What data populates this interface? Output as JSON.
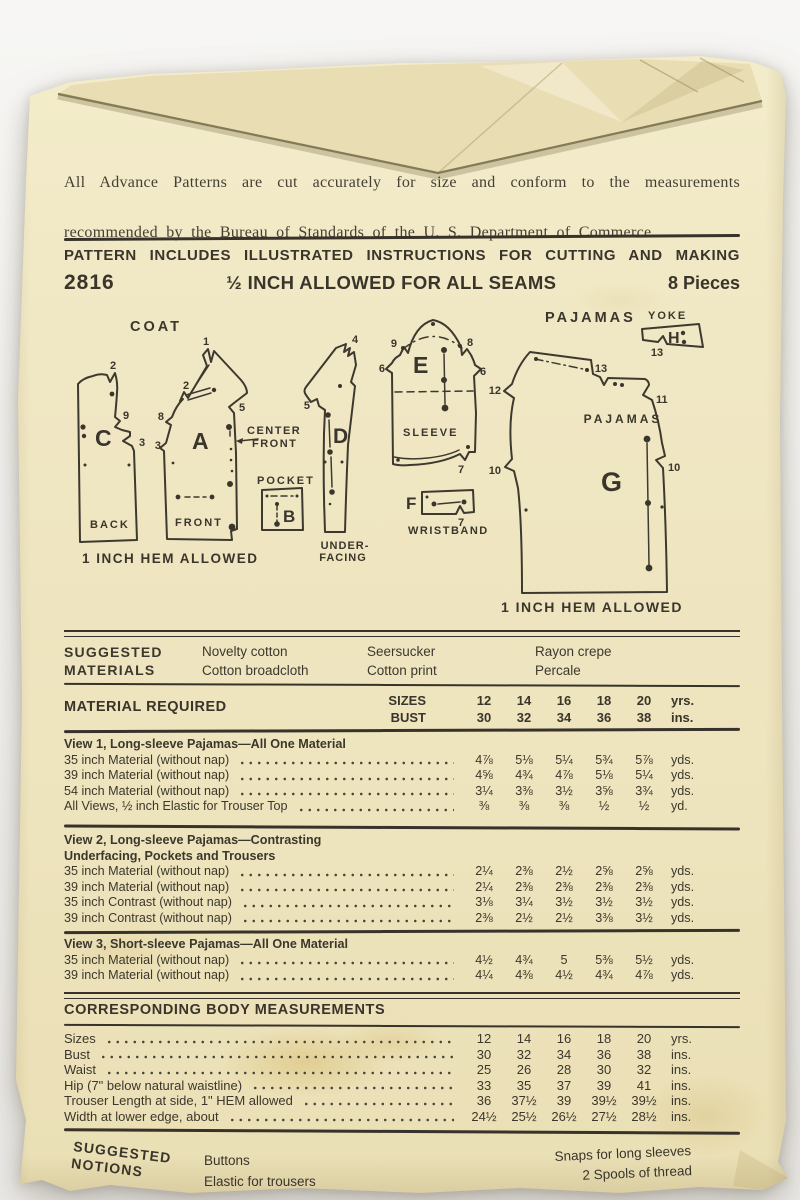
{
  "intro": {
    "line1": "All Advance Patterns are cut accurately for size and conform to the measurements",
    "line2": "recommended by the Bureau of Standards of the U. S. Department of Commerce."
  },
  "header": {
    "includes_line": "PATTERN INCLUDES ILLUSTRATED INSTRUCTIONS FOR CUTTING AND MAKING",
    "pattern_number": "2816",
    "seam_allowance": "½ INCH ALLOWED FOR ALL SEAMS",
    "piece_count": "8 Pieces"
  },
  "diagram": {
    "coat_label": "COAT",
    "pajamas_label": "PAJAMAS",
    "yoke_label": "YOKE",
    "coat_hem_note": "1 INCH HEM ALLOWED",
    "pajamas_hem_note": "1 INCH HEM ALLOWED",
    "pieces": {
      "back": {
        "letter": "C",
        "name": "BACK",
        "notches": [
          "2",
          "9",
          "3"
        ]
      },
      "front": {
        "letter": "A",
        "name": "FRONT",
        "notches": [
          "1",
          "2",
          "8",
          "3",
          "5"
        ],
        "center_front_line1": "CENTER",
        "center_front_line2": "FRONT"
      },
      "pocket": {
        "letter": "B",
        "name": "POCKET"
      },
      "underfacing": {
        "letter": "D",
        "name_line1": "UNDER-",
        "name_line2": "FACING",
        "notches": [
          "4",
          "5"
        ]
      },
      "sleeve": {
        "letter": "E",
        "name": "SLEEVE",
        "notches": [
          "9",
          "8",
          "6",
          "6",
          "7"
        ]
      },
      "wristband": {
        "letter": "F",
        "name": "WRISTBAND",
        "notches": [
          "7"
        ]
      },
      "pajama_pant": {
        "letter": "G",
        "name": "PAJAMAS",
        "notches": [
          "12",
          "13",
          "11",
          "10",
          "10"
        ]
      },
      "yoke": {
        "letter": "H",
        "notches": [
          "13"
        ]
      }
    }
  },
  "materials": {
    "label_line1": "SUGGESTED",
    "label_line2": "MATERIALS",
    "columns": [
      {
        "line1": "Novelty cotton",
        "line2": "Cotton broadcloth"
      },
      {
        "line1": "Seersucker",
        "line2": "Cotton print"
      },
      {
        "line1": "Rayon crepe",
        "line2": "Percale"
      }
    ]
  },
  "material_required": {
    "title": "MATERIAL REQUIRED",
    "sizes_label": "SIZES",
    "bust_label": "BUST",
    "sizes": [
      "12",
      "14",
      "16",
      "18",
      "20"
    ],
    "sizes_unit": "yrs.",
    "bust": [
      "30",
      "32",
      "34",
      "36",
      "38"
    ],
    "bust_unit": "ins."
  },
  "views": [
    {
      "title_line1": "View 1, Long-sleeve Pajamas—All One Material",
      "rows": [
        {
          "label": "35 inch Material (without nap)",
          "values": [
            "4⅞",
            "5⅛",
            "5¼",
            "5¾",
            "5⅞"
          ],
          "unit": "yds."
        },
        {
          "label": "39 inch Material (without nap)",
          "values": [
            "4⅝",
            "4¾",
            "4⅞",
            "5⅛",
            "5¼"
          ],
          "unit": "yds."
        },
        {
          "label": "54 inch Material (without nap)",
          "values": [
            "3¼",
            "3⅜",
            "3½",
            "3⅝",
            "3¾"
          ],
          "unit": "yds."
        },
        {
          "label": "All Views, ½ inch Elastic for Trouser Top",
          "values": [
            "⅜",
            "⅜",
            "⅜",
            "½",
            "½"
          ],
          "unit": "yd."
        }
      ]
    },
    {
      "title_line1": "View 2, Long-sleeve Pajamas—Contrasting",
      "title_line2": "Underfacing, Pockets and Trousers",
      "rows": [
        {
          "label": "35 inch Material (without nap)",
          "values": [
            "2¼",
            "2⅜",
            "2½",
            "2⅝",
            "2⅝"
          ],
          "unit": "yds."
        },
        {
          "label": "39 inch Material (without nap)",
          "values": [
            "2¼",
            "2⅜",
            "2⅜",
            "2⅜",
            "2⅜"
          ],
          "unit": "yds."
        },
        {
          "label": "35 inch Contrast (without nap)",
          "values": [
            "3⅛",
            "3¼",
            "3½",
            "3½",
            "3½"
          ],
          "unit": "yds."
        },
        {
          "label": "39 inch Contrast (without nap)",
          "values": [
            "2⅜",
            "2½",
            "2½",
            "3⅜",
            "3½"
          ],
          "unit": "yds."
        }
      ]
    },
    {
      "title_line1": "View 3, Short-sleeve Pajamas—All One Material",
      "rows": [
        {
          "label": "35 inch Material (without nap)",
          "values": [
            "4½",
            "4¾",
            "5",
            "5⅜",
            "5½"
          ],
          "unit": "yds."
        },
        {
          "label": "39 inch Material (without nap)",
          "values": [
            "4¼",
            "4⅜",
            "4½",
            "4¾",
            "4⅞"
          ],
          "unit": "yds."
        }
      ]
    }
  ],
  "body_measurements": {
    "title": "CORRESPONDING BODY MEASUREMENTS",
    "rows": [
      {
        "label": "Sizes",
        "values": [
          "12",
          "14",
          "16",
          "18",
          "20"
        ],
        "unit": "yrs."
      },
      {
        "label": "Bust",
        "values": [
          "30",
          "32",
          "34",
          "36",
          "38"
        ],
        "unit": "ins."
      },
      {
        "label": "Waist",
        "values": [
          "25",
          "26",
          "28",
          "30",
          "32"
        ],
        "unit": "ins."
      },
      {
        "label": "Hip (7\" below natural waistline)",
        "values": [
          "33",
          "35",
          "37",
          "39",
          "41"
        ],
        "unit": "ins."
      },
      {
        "label": "Trouser Length at side, 1\" HEM allowed",
        "values": [
          "36",
          "37½",
          "39",
          "39½",
          "39½"
        ],
        "unit": "ins."
      },
      {
        "label": "Width at lower edge, about",
        "values": [
          "24½",
          "25½",
          "26½",
          "27½",
          "28½"
        ],
        "unit": "ins."
      }
    ]
  },
  "notions": {
    "label_line1": "SUGGESTED",
    "label_line2": "NOTIONS",
    "left_items": [
      "Buttons",
      "Elastic for trousers"
    ],
    "right_items": [
      "Snaps for long sleeves",
      "2 Spools of thread"
    ]
  }
}
